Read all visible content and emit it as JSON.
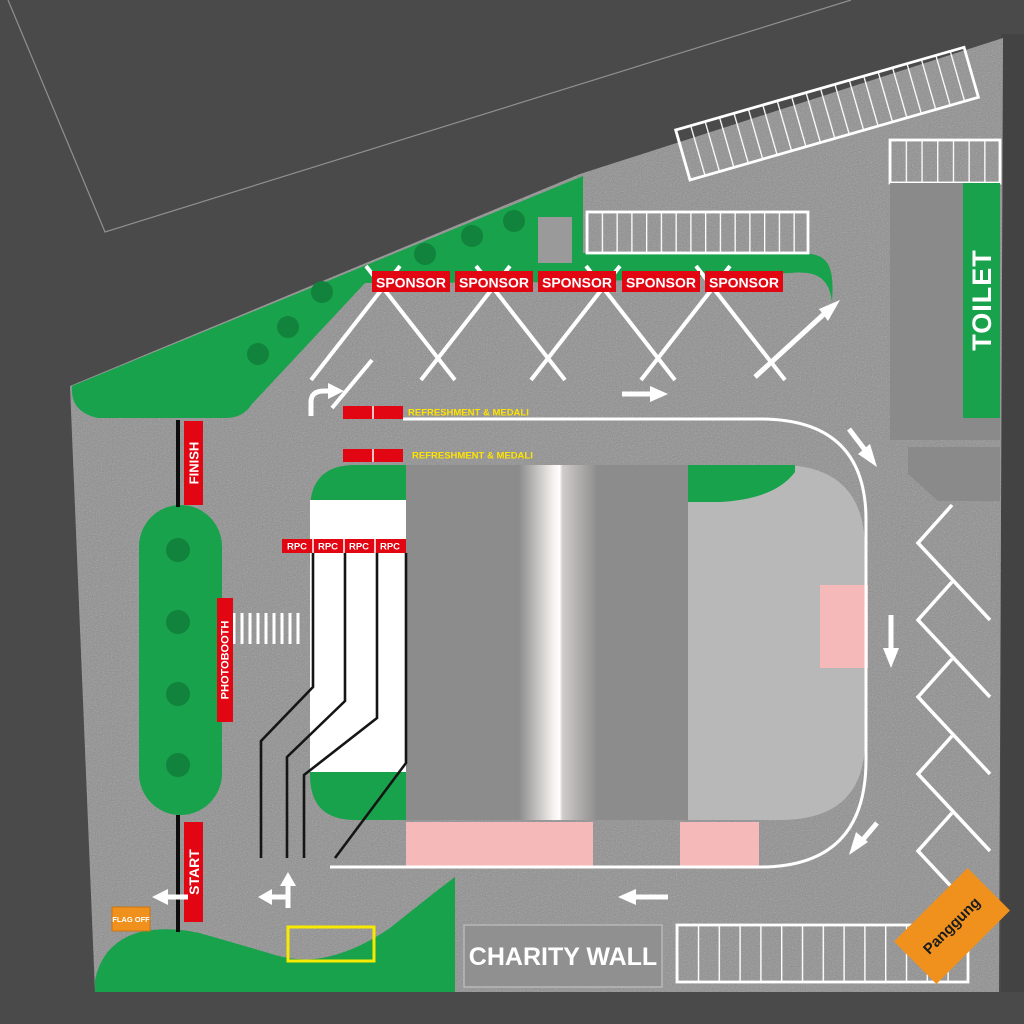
{
  "title": "Event site plan",
  "labels": {
    "sponsor": "SPONSOR",
    "refreshment": "REFRESHMENT & MEDALI",
    "rpc": "RPC",
    "finish": "FINISH",
    "start": "START",
    "photobooth": "PHOTOBOOTH",
    "flag_off": "FLAG OFF",
    "toilet": "TOILET",
    "charity_wall": "CHARITY WALL",
    "stage": "Panggung"
  },
  "counts": {
    "sponsor_booths": 5,
    "rpc_counters": 4,
    "refreshment_stations": 2,
    "parking_rows": {
      "top_diagonal_stalls": 20,
      "mid_row_stalls": 15,
      "toilet_row_stalls": 7,
      "bottom_row_stalls": 14
    }
  },
  "colors": {
    "background": "#4a4a4a",
    "asphalt": "#8e8e8e",
    "green": "#18a24c",
    "dark_green": "#11833c",
    "red": "#e20613",
    "yellow": "#ffe300",
    "pink": "#f4b9b8",
    "orange": "#f0911e",
    "building_gray": "#8c8c8c",
    "building_light": "#b8b8b8",
    "line_white": "#ffffff"
  }
}
